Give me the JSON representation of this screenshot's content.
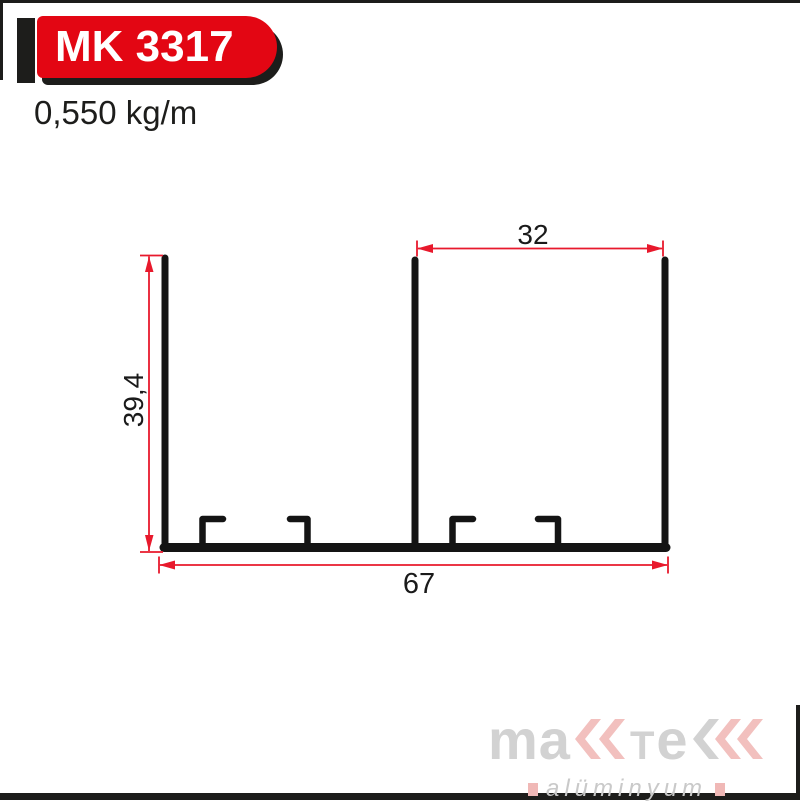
{
  "page": {
    "background": "#ffffff",
    "border_color": "#1d1d1b"
  },
  "header": {
    "badge_label": "MK 3317",
    "badge_bg": "#e30613",
    "badge_text_color": "#ffffff",
    "badge_accent_color": "#1d1d1b",
    "weight": "0,550 kg/m"
  },
  "drawing": {
    "type": "aluminium-profile-cross-section",
    "profile_color": "#141414",
    "dimension_color": "#e8192c",
    "dimensions": {
      "overall_width": "67",
      "overall_height": "39,4",
      "inner_width": "32"
    }
  },
  "footer": {
    "brand": "maktek",
    "brand_part_ma": "ma",
    "brand_part_t": "T",
    "brand_part_e": "e",
    "subtitle": "alüminyum",
    "logo_gray": "#d2d2d2",
    "logo_pink": "#f2c0be"
  }
}
